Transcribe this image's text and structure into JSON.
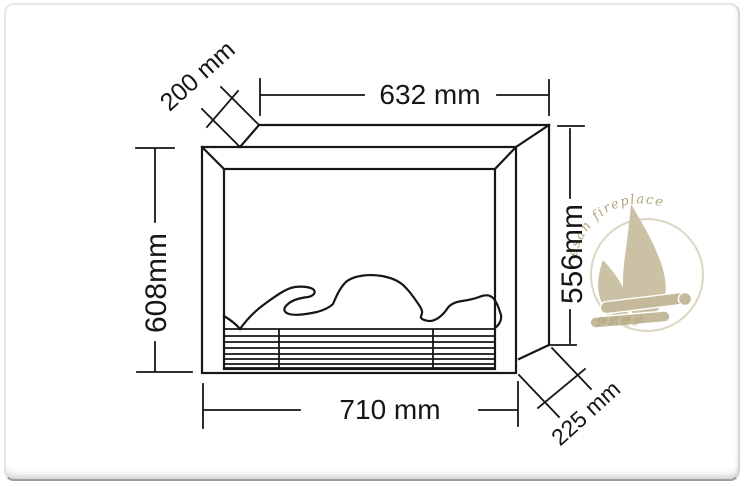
{
  "drawing": {
    "subject": "fireplace insert dimension drawing",
    "unit": "mm",
    "dimensions": {
      "top_width": {
        "label": "632 mm",
        "value": 632
      },
      "bottom_width": {
        "label": "710 mm",
        "value": 710
      },
      "left_height": {
        "label": "608mm",
        "value": 608
      },
      "right_height": {
        "label": "556mm",
        "value": 556
      },
      "top_depth": {
        "label": "200 mm",
        "value": 200
      },
      "bottom_depth": {
        "label": "225 mm",
        "value": 225
      }
    }
  },
  "watermark": {
    "arc_text": "esan fireplace",
    "cjk_text": "伊凯壁炉"
  },
  "colors": {
    "line": "#161616",
    "watermark_shape": "#c7bc9d",
    "watermark_text": "#ab9c70",
    "frame_border": "#9e9e9e",
    "background": "#ffffff"
  }
}
